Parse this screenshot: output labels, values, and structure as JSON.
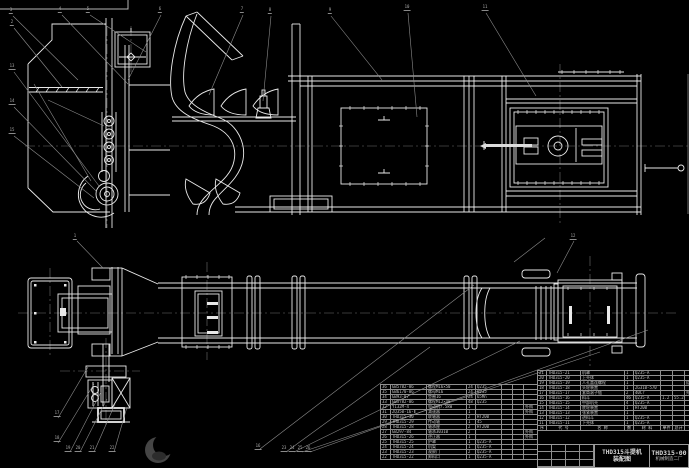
{
  "drawing": {
    "view_labels": {
      "main_view": "elevation-view",
      "plan_view": "plan-view"
    },
    "colors": {
      "line": "#e9e9e9",
      "dim_gray": "#8c8c8c",
      "text": "#c4c4c4",
      "background": "#000000"
    },
    "title_block": {
      "product": "THD315斗提机",
      "subtitle": "装配图",
      "drawing_no": "THD315-00",
      "company": "机械制造二厂"
    },
    "bom_right": {
      "header": [
        "序",
        "代  号",
        "名  称",
        "数",
        "材 料",
        "单件",
        "总计",
        "备注"
      ],
      "rows": [
        [
          "21",
          "THD315-21",
          "机罩",
          "1",
          "Q235-A",
          "",
          "",
          ""
        ],
        [
          "20",
          "THD315-20",
          "上壳体",
          "1",
          "Q235-A",
          "",
          "",
          ""
        ],
        [
          "19",
          "THD315-19",
          "人孔盖连螺栓",
          "1",
          "",
          "",
          "",
          "组合件"
        ],
        [
          "18",
          "THD315-18",
          "头轮装置",
          "1",
          "ZG310-570",
          "",
          "",
          ""
        ],
        [
          "17",
          "THD315-17",
          "套筒滚子链",
          "2",
          "40Cr",
          "",
          "",
          "外购"
        ],
        [
          "16",
          "THD315-16",
          "料斗",
          "46",
          "Q235-A",
          "1.2",
          "55.2",
          ""
        ],
        [
          "15",
          "THD315-15",
          "中部机壳",
          "4",
          "Q235-A",
          "",
          "",
          ""
        ],
        [
          "14",
          "THD315-14",
          "底轮装置",
          "1",
          "HT200",
          "",
          "",
          ""
        ],
        [
          "13",
          "THD315-13",
          "张紧装置",
          "1",
          "",
          "",
          "",
          ""
        ],
        [
          "12",
          "THD315-12",
          "进料斗",
          "1",
          "Q235-A",
          "",
          "",
          ""
        ],
        [
          "11",
          "THD315-11",
          "下壳体",
          "1",
          "Q235-A",
          "",
          "",
          ""
        ]
      ]
    },
    "bom_left": {
      "rows": [
        [
          "36",
          "GB5782-86",
          "螺栓M16×50",
          "24",
          "Q235",
          "",
          "",
          ""
        ],
        [
          "35",
          "GB6170-86",
          "螺母M16",
          "24",
          "Q235",
          "",
          "",
          ""
        ],
        [
          "34",
          "GB93-87",
          "垫圈16",
          "24",
          "65Mn",
          "",
          "",
          ""
        ],
        [
          "33",
          "GB5782-86",
          "螺栓M12×40",
          "48",
          "Q235",
          "",
          "",
          ""
        ],
        [
          "32",
          "Y132M-4",
          "电动机7.5kW",
          "1",
          "",
          "",
          "",
          "外购"
        ],
        [
          "31",
          "ZQ350-16-Ⅱ",
          "减速器",
          "1",
          "",
          "",
          "",
          "外购"
        ],
        [
          "30",
          "THD315-30",
          "联轴器",
          "2",
          "HT200",
          "",
          "",
          ""
        ],
        [
          "29",
          "THD315-29",
          "传动轴",
          "1",
          "45",
          "",
          "",
          ""
        ],
        [
          "28",
          "THD315-28",
          "轴承座",
          "2",
          "HT200",
          "",
          "",
          ""
        ],
        [
          "27",
          "GB297-84",
          "轴承30310",
          "2",
          "",
          "",
          "",
          "外购"
        ],
        [
          "26",
          "THD315-26",
          "逆止器",
          "1",
          "",
          "",
          "",
          "外购"
        ],
        [
          "25",
          "THD315-25",
          "护罩",
          "1",
          "Q235-A",
          "",
          "",
          ""
        ],
        [
          "24",
          "THD315-24",
          "机架",
          "1",
          "Q235-A",
          "",
          "",
          ""
        ],
        [
          "23",
          "THD315-23",
          "观察门",
          "2",
          "Q235-A",
          "",
          "",
          ""
        ],
        [
          "22",
          "THD315-22",
          "卸料口",
          "1",
          "Q235-A",
          "",
          "",
          ""
        ]
      ]
    },
    "balloons": [
      {
        "n": "3",
        "x": 11,
        "y": 14
      },
      {
        "n": "4",
        "x": 60,
        "y": 13
      },
      {
        "n": "5",
        "x": 88,
        "y": 13
      },
      {
        "n": "6",
        "x": 160,
        "y": 13
      },
      {
        "n": "7",
        "x": 242,
        "y": 13
      },
      {
        "n": "8",
        "x": 270,
        "y": 14
      },
      {
        "n": "9",
        "x": 330,
        "y": 14
      },
      {
        "n": "10",
        "x": 407,
        "y": 11
      },
      {
        "n": "11",
        "x": 485,
        "y": 11
      },
      {
        "n": "2",
        "x": 12,
        "y": 26
      },
      {
        "n": "13",
        "x": 12,
        "y": 70
      },
      {
        "n": "14",
        "x": 12,
        "y": 105
      },
      {
        "n": "15",
        "x": 12,
        "y": 134
      },
      {
        "n": "1",
        "x": 75,
        "y": 240
      },
      {
        "n": "12",
        "x": 573,
        "y": 240
      },
      {
        "n": "17",
        "x": 57,
        "y": 417
      },
      {
        "n": "18",
        "x": 57,
        "y": 442
      },
      {
        "n": "19",
        "x": 68,
        "y": 452
      },
      {
        "n": "20",
        "x": 78,
        "y": 452
      },
      {
        "n": "21",
        "x": 92,
        "y": 452
      },
      {
        "n": "22",
        "x": 112,
        "y": 452
      },
      {
        "n": "16",
        "x": 258,
        "y": 450
      },
      {
        "n": "23",
        "x": 284,
        "y": 452
      },
      {
        "n": "24",
        "x": 292,
        "y": 452
      },
      {
        "n": "25",
        "x": 300,
        "y": 452
      },
      {
        "n": "26",
        "x": 308,
        "y": 452
      }
    ]
  }
}
